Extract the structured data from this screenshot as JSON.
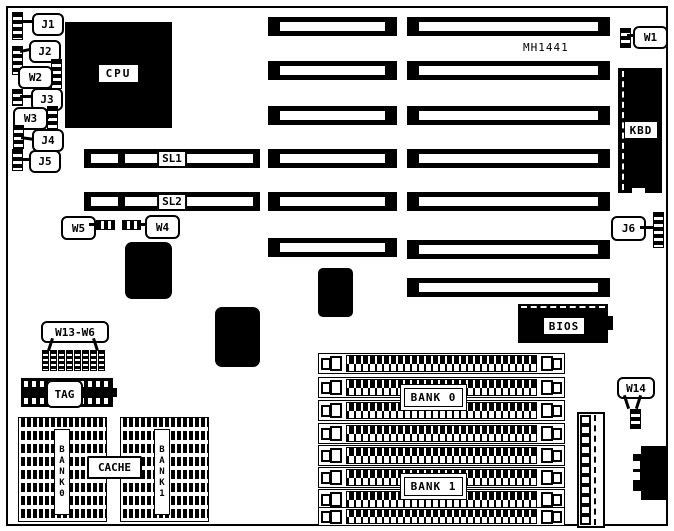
{
  "board": {
    "model": "MH1441"
  },
  "callouts": {
    "j1": "J1",
    "j2": "J2",
    "w2": "W2",
    "j3": "J3",
    "w3": "W3",
    "j4": "J4",
    "j5": "J5",
    "w5": "W5",
    "w4": "W4",
    "w1": "W1",
    "j6": "J6",
    "w13_w6": "W13-W6",
    "w14": "W14"
  },
  "components": {
    "cpu": "CPU",
    "kbd": "KBD",
    "bios": "BIOS",
    "tag": "TAG",
    "cache": "CACHE",
    "sl1": "SL1",
    "sl2": "SL2",
    "bank0": "BANK 0",
    "bank1": "BANK 1",
    "bank0_vertical": "BANK0",
    "bank1_vertical": "BANK1"
  }
}
